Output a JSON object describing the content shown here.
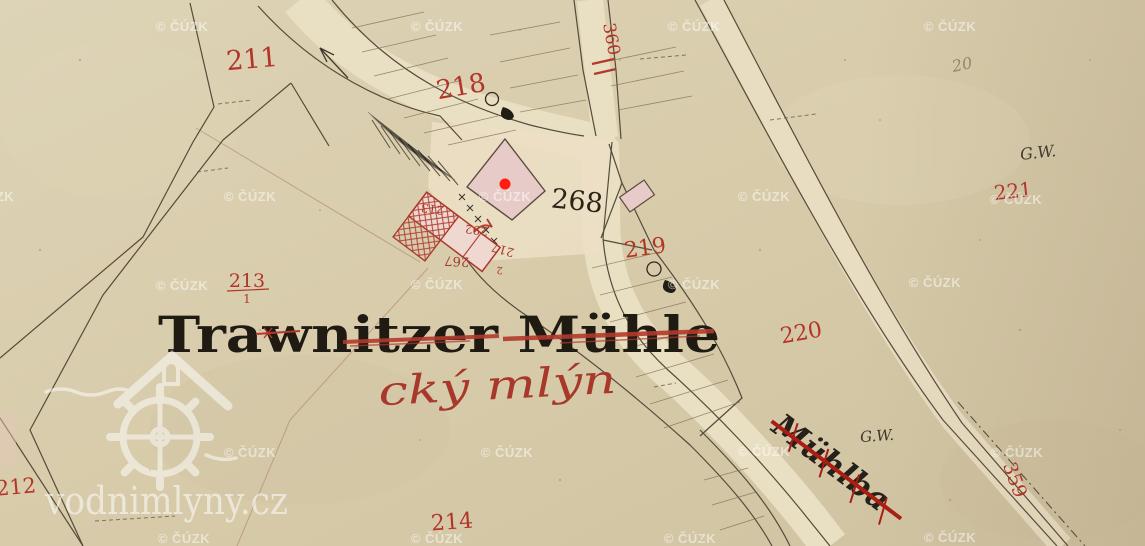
{
  "colors": {
    "paper": "#d8cdad",
    "red_ink": "#b23529",
    "black_ink": "#1f1b13",
    "boundary_brown": "#564a3a",
    "building_pink": "#e7cbc8",
    "building_red_outline": "#a93a2c",
    "marker_red": "#ff1d12",
    "watermark_white": "#ffffff",
    "pencil_gray": "#8d8a72"
  },
  "title": {
    "german": "Trawnitzer Mühle",
    "czech": "cký mlýn"
  },
  "stream_label": "Mühlba",
  "parcels": {
    "p211": "211",
    "p218": "218",
    "p213": "213",
    "p213_den": "1",
    "p212": "212",
    "p214": "214",
    "p219": "219",
    "p220": "220",
    "p221": "221",
    "p268": "268",
    "p359": "359",
    "p360": "360"
  },
  "small_numbers": {
    "n213": "213",
    "n292": "292",
    "n267": "267",
    "n217": "217",
    "n2": "2"
  },
  "annotations": {
    "gw_upper": "G.W.",
    "gw_lower": "G.W.",
    "pencil_note": "20"
  },
  "watermark": {
    "text": "© ČÚZK",
    "positions": [
      [
        182,
        31
      ],
      [
        437,
        31
      ],
      [
        694,
        31
      ],
      [
        950,
        31
      ],
      [
        -12,
        201
      ],
      [
        250,
        201
      ],
      [
        505,
        201
      ],
      [
        764,
        201
      ],
      [
        1016,
        204
      ],
      [
        182,
        290
      ],
      [
        437,
        289
      ],
      [
        694,
        289
      ],
      [
        935,
        287
      ],
      [
        250,
        457
      ],
      [
        507,
        457
      ],
      [
        764,
        456
      ],
      [
        1017,
        457
      ],
      [
        184,
        543
      ],
      [
        437,
        543
      ],
      [
        690,
        543
      ],
      [
        950,
        542
      ]
    ]
  },
  "branding": {
    "site": "vodnimlyny.cz"
  },
  "marker": {
    "x": 505,
    "y": 184
  }
}
